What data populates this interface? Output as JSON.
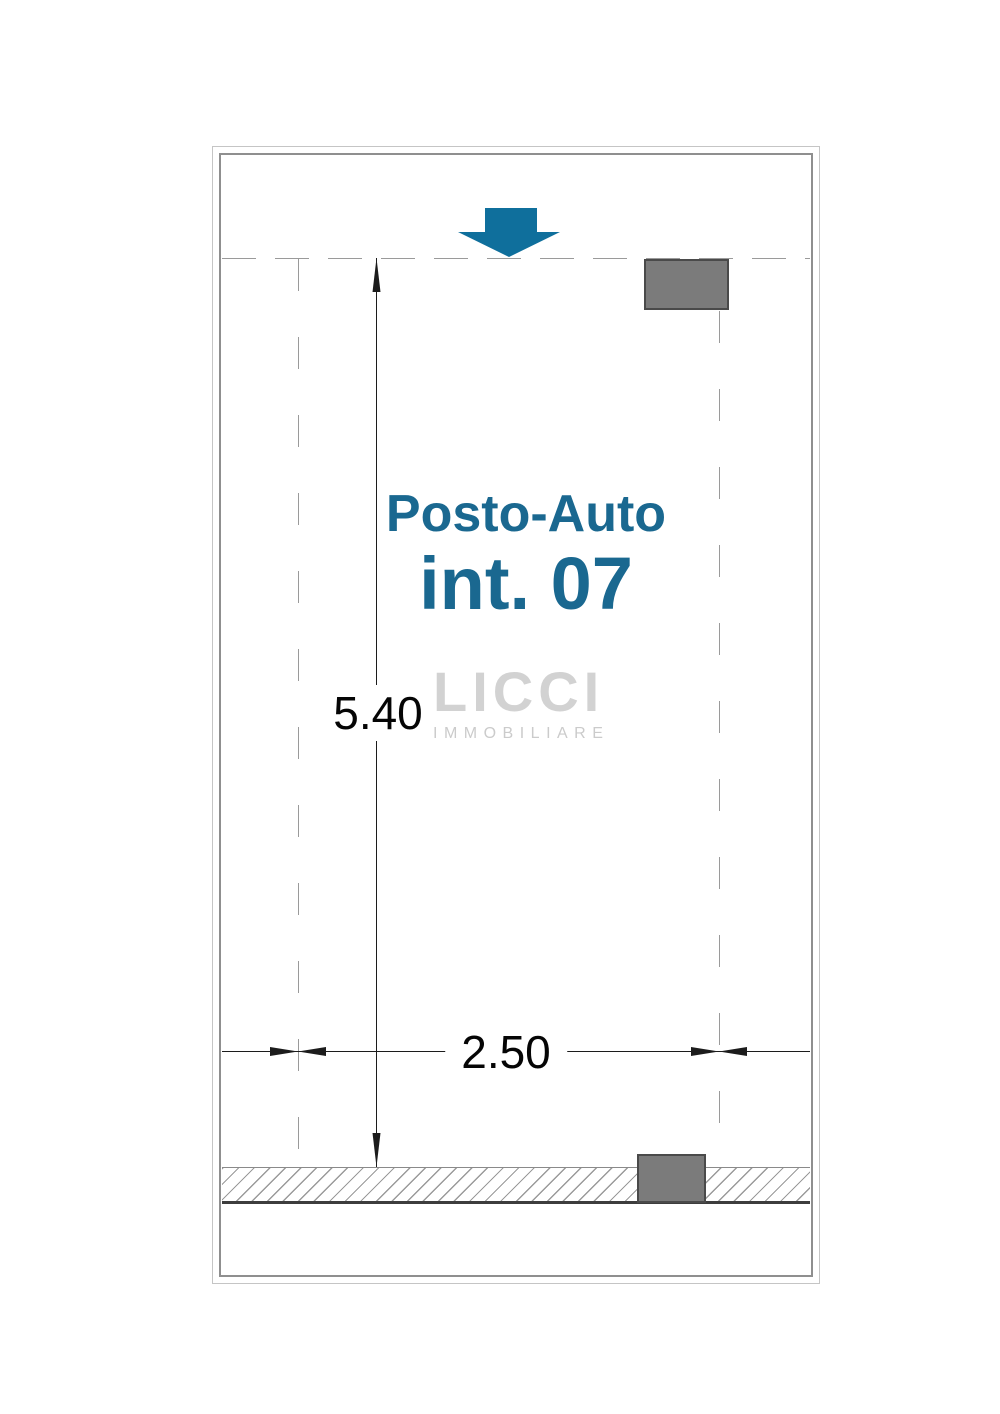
{
  "plan": {
    "unit": {
      "line1": "Posto-Auto",
      "line2": "int. 07"
    },
    "dimensions": {
      "height_label": "5.40",
      "width_label": "2.50"
    },
    "watermark": {
      "brand": "LICCI",
      "tagline": "IMMOBILIARE"
    },
    "icons": {
      "entrance_arrow": "down-arrow"
    }
  },
  "colors": {
    "accent": "#0f6f9c",
    "title": "#1a6890",
    "pillar": "#7b7b7b",
    "pillar-border": "#4a4a4a",
    "dash": "#9a9a9a",
    "dim": "#1c1c1c",
    "frame-outer": "#c5c5c5",
    "frame-inner": "#8f8f8f",
    "watermark": "#d2d2d2",
    "watermark2": "#cbcbcb",
    "hatch": "#9a9a9a",
    "strip-dark": "#3d3d3d"
  }
}
